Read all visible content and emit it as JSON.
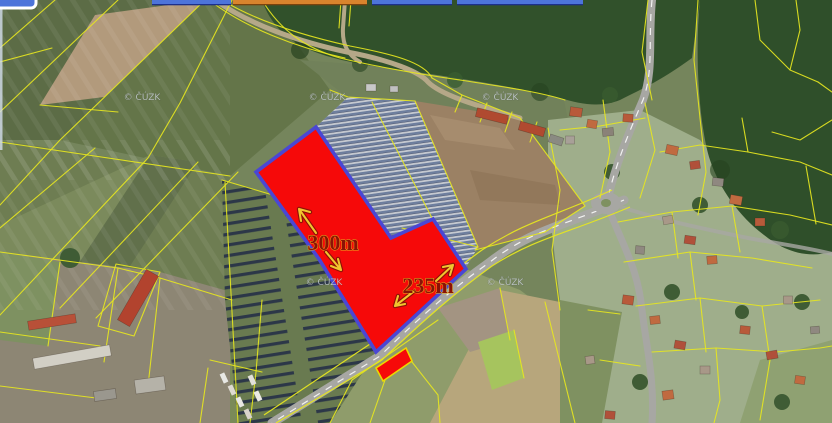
{
  "toolbar": {
    "fragments": [
      {
        "id": "fragment-1",
        "color": "#4d74da"
      },
      {
        "id": "fragment-2",
        "color": "#4d74da"
      },
      {
        "id": "fragment-3",
        "color": "#d9842d"
      },
      {
        "id": "fragment-4",
        "color": "#4d74da"
      },
      {
        "id": "fragment-5",
        "color": "#4d74da"
      }
    ]
  },
  "map": {
    "watermark": "© ČÚZK",
    "dimension_labels": [
      {
        "id": "dim-300",
        "value": "300m"
      },
      {
        "id": "dim-235",
        "value": "235m"
      }
    ],
    "colors": {
      "highlight_fill": "#f60909",
      "highlight_border": "#4a47d4",
      "cadastral_line": "#e6e620",
      "arrow": "#f0c52e",
      "dimension_text": "#8a1206",
      "small_parcel_border": "#ecd800"
    }
  }
}
